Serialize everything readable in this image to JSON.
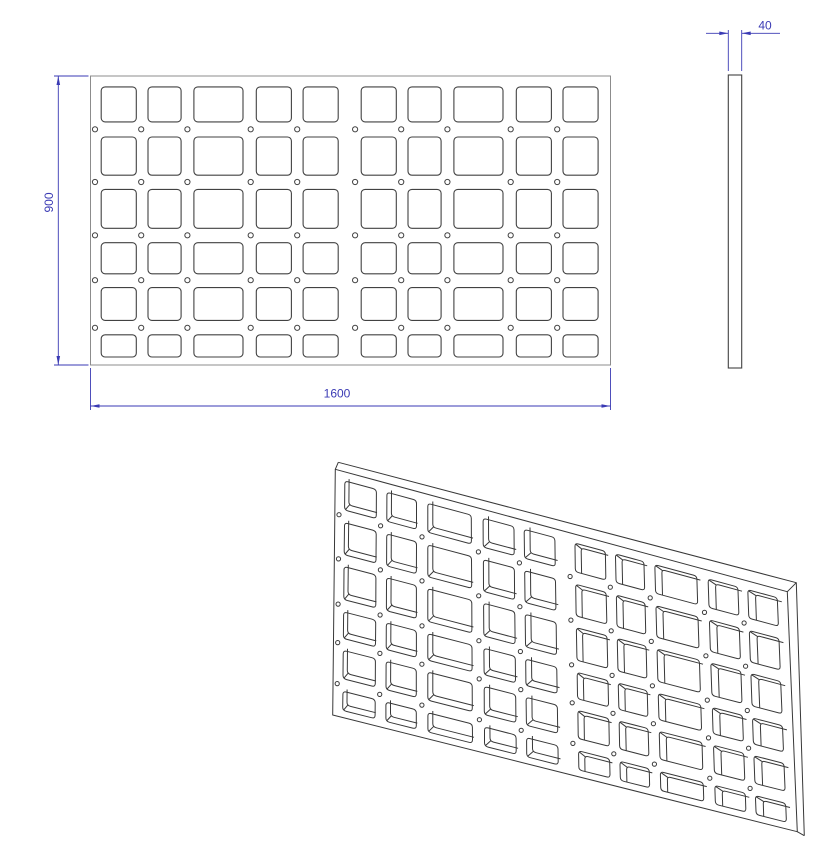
{
  "drawing": {
    "title": "grate-plate-drawing",
    "labels": {
      "width": "1600",
      "height": "900",
      "thickness": "40"
    },
    "part": {
      "width_mm": 1600,
      "height_mm": 900,
      "thickness_mm": 40,
      "corner_radius_mm": 12,
      "hole_radius_mm": 8,
      "cutout_cols": [
        [
          33,
          108
        ],
        [
          177,
          102
        ],
        [
          318,
          151
        ],
        [
          510,
          108
        ],
        [
          654,
          108
        ],
        [
          833,
          108
        ],
        [
          977,
          102
        ],
        [
          1118,
          151
        ],
        [
          1310,
          108
        ],
        [
          1454,
          108
        ]
      ],
      "cutout_rows": [
        [
          34,
          109
        ],
        [
          190,
          119
        ],
        [
          353,
          121
        ],
        [
          519,
          97
        ],
        [
          659,
          102
        ],
        [
          806,
          69
        ]
      ],
      "hole_cols": [
        14,
        156,
        298,
        493,
        636,
        814,
        956,
        1098,
        1293,
        1436
      ],
      "hole_rows": [
        166,
        330,
        496,
        636,
        784
      ]
    },
    "colors": {
      "background": "#ffffff",
      "dimension": "#3a3ab4",
      "outline": "#8c8c8c",
      "feature": "#424242",
      "iso_edge": "#383838"
    },
    "views": {
      "front": {
        "x": 90.5,
        "y": 76,
        "w": 520,
        "h": 289
      },
      "side": {
        "x": 728.3,
        "y": 75,
        "w": 13.4,
        "h": 293
      },
      "iso": {
        "tl": [
          335.3,
          469.3
        ],
        "tr": [
          787.3,
          591.7
        ],
        "br": [
          797.3,
          831.7
        ],
        "bl": [
          332.7,
          715.0
        ],
        "off_tl": [
          3,
          -7
        ],
        "off_tr": [
          9,
          -9
        ],
        "off_br": [
          7,
          4
        ],
        "off_bl": [
          3,
          -3
        ]
      }
    },
    "dims": {
      "height": {
        "line": [
          [
            58.3,
            76
          ],
          [
            58.3,
            365
          ]
        ],
        "ext": [
          [
            [
              54,
              76
            ],
            [
              88.5,
              76
            ]
          ],
          [
            [
              54,
              365
            ],
            [
              88.5,
              365
            ]
          ]
        ],
        "arrows": [
          [
            58.3,
            76,
            "up"
          ],
          [
            58.3,
            365,
            "down"
          ]
        ],
        "text": {
          "x": 53,
          "y": 202.5,
          "rotate": -90
        }
      },
      "width": {
        "line": [
          [
            90.5,
            406
          ],
          [
            610.5,
            406
          ]
        ],
        "ext": [
          [
            [
              90.5,
              368
            ],
            [
              90.5,
              410
            ]
          ],
          [
            [
              610.5,
              368
            ],
            [
              610.5,
              410
            ]
          ]
        ],
        "arrows": [
          [
            90.5,
            406,
            "left"
          ],
          [
            610.5,
            406,
            "right"
          ]
        ],
        "text": {
          "x": 337,
          "y": 397.5,
          "rotate": 0
        }
      },
      "thickness": {
        "segs": [
          [
            [
              706,
              33.3
            ],
            [
              728.3,
              33.3
            ]
          ],
          [
            [
              741.7,
              33.3
            ],
            [
              780,
              33.3
            ]
          ]
        ],
        "ext": [
          [
            [
              728.3,
              30
            ],
            [
              728.3,
              71
            ]
          ],
          [
            [
              741.7,
              30
            ],
            [
              741.7,
              71
            ]
          ]
        ],
        "arrows": [
          [
            728.3,
            33.3,
            "right"
          ],
          [
            741.7,
            33.3,
            "left"
          ]
        ],
        "text": {
          "x": 765,
          "y": 29.5,
          "rotate": 0
        }
      }
    }
  }
}
